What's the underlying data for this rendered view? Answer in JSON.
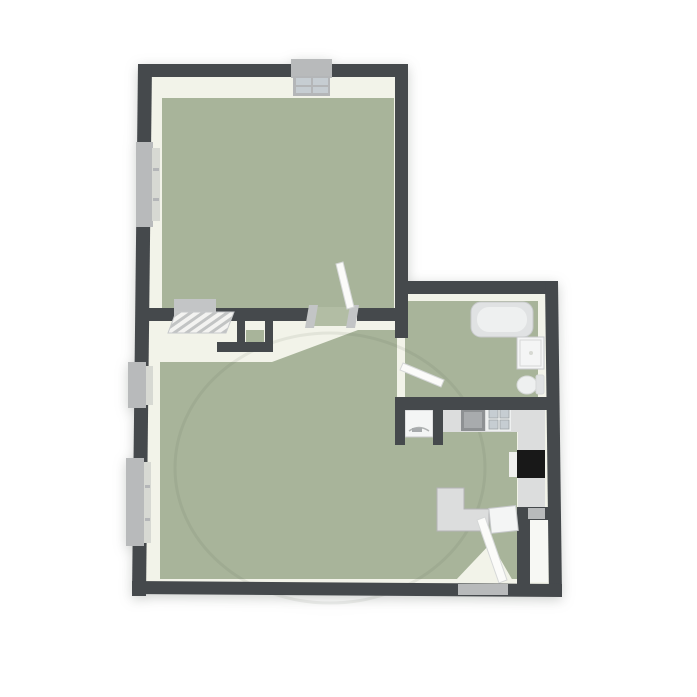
{
  "palette": {
    "wall": "#45494c",
    "floor_light": "#f2f3e9",
    "floor_green": "#a8b49a",
    "floor_green_light": "#b2bda4",
    "window_gray": "#b8babb",
    "sill": "#d7d9d3",
    "fixture_white": "#f4f5f5",
    "fixture_light": "#e0e2e3",
    "fixture_inner": "#eef0f0",
    "counter": "#dcdddd",
    "counter_dark": "#8e9193",
    "counter_dark_inner": "#a8abad",
    "appliance_black": "#181818",
    "appliance_handle": "#f0f0ee",
    "door_leaf": "#fbfbf9",
    "radiator_pane": "#c6cdd2",
    "radiator_base": "#b4b6b8",
    "threshold_gray": "#c3c5c6",
    "closet_light": "#f7f8f4",
    "canvas": "#ffffff"
  },
  "plan": {
    "type": "3d-top-down-floor-plan",
    "rooms": [
      {
        "id": "bedroom",
        "floor": "green"
      },
      {
        "id": "hallway",
        "floor": "light"
      },
      {
        "id": "living-room",
        "floor": "green"
      },
      {
        "id": "bathroom",
        "floor": "green"
      },
      {
        "id": "kitchen",
        "floor": "green"
      },
      {
        "id": "entry-closet",
        "floor": "light"
      }
    ],
    "fixtures": [
      "window",
      "radiator",
      "interior-door",
      "bathroom-door",
      "entry-door",
      "bathtub",
      "vanity-sink",
      "toilet",
      "kitchen-counter",
      "kitchen-sink",
      "cooktop",
      "oven",
      "washing-machine",
      "l-shaped-counter",
      "entry-cabinet",
      "duct-shaft",
      "closet"
    ]
  }
}
